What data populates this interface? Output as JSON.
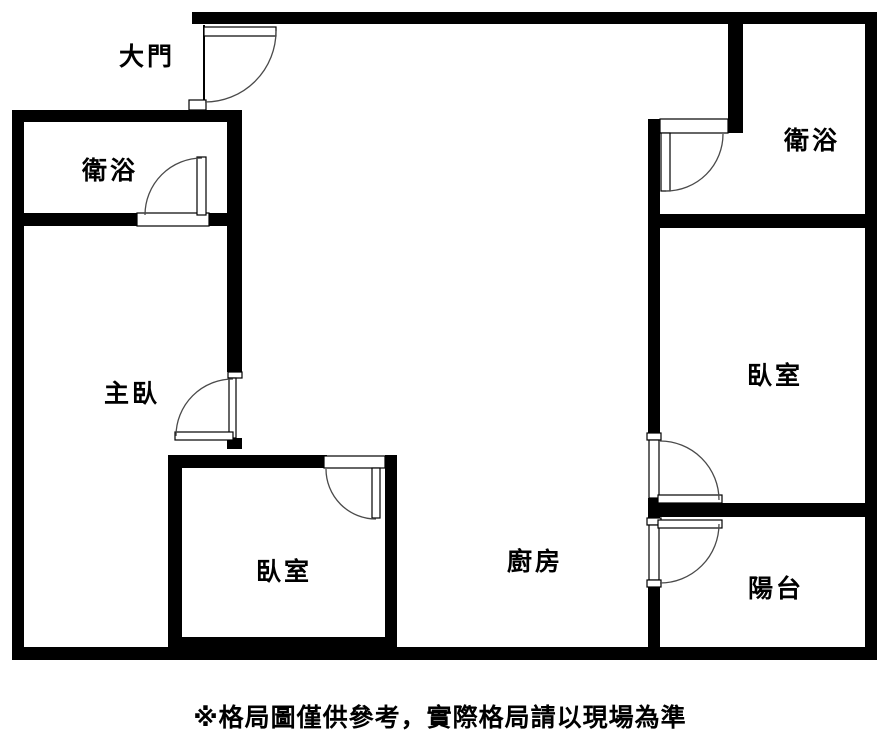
{
  "floorplan": {
    "caption": "※格局圖僅供參考，實際格局請以現場為準",
    "colors": {
      "wall": "#000000",
      "door_line": "#4a4a4a",
      "background": "#ffffff"
    },
    "labels": {
      "main_door": "大門",
      "bathroom_left": "衛浴",
      "bathroom_right": "衛浴",
      "master_bedroom": "主臥",
      "bedroom_bottom": "臥室",
      "bedroom_right": "臥室",
      "kitchen": "廚房",
      "balcony": "陽台"
    }
  }
}
